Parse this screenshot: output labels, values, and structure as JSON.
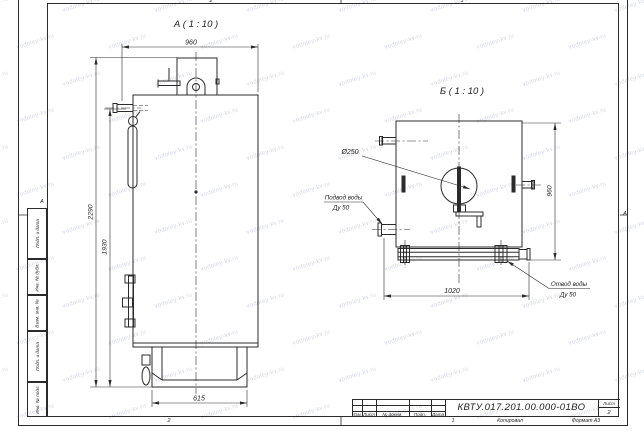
{
  "sheet": {
    "background": "#ffffff",
    "line_color": "#2b2b2b",
    "watermark": "vodoley-kv.ru",
    "zones": {
      "top_left": "2",
      "top_right": "1",
      "bottom_left": "2",
      "bottom_right": "1",
      "side_left": "А",
      "side_right": "А"
    }
  },
  "views": {
    "a": {
      "title": "А ( 1 : 10 )",
      "dim_width": "960",
      "dim_height_total": "2290",
      "dim_height_body": "1930",
      "dim_base": "615"
    },
    "b": {
      "title": "Б ( 1 : 10 )",
      "dim_width": "1020",
      "dim_height": "960",
      "dim_flue": "Ø250",
      "inlet_label": "Подвод воды",
      "inlet_size": "Ду 50",
      "outlet_label": "Отвод воды",
      "outlet_size": "Ду 50"
    }
  },
  "title_block": {
    "doc_number": "КВТУ.017.201.00.000-01ВО",
    "sheet_label": "Лист",
    "sheet_number": "2",
    "headers": [
      "Изм.",
      "Лист",
      "№ докум.",
      "Подп.",
      "Дата"
    ],
    "copied_label": "Копировал",
    "format_label": "Формат А3"
  },
  "side_stamp": [
    "Подп. и дата",
    "Инв. № дубл.",
    "Взам. инв. №",
    "Подп. и дата",
    "Инв. № подл."
  ]
}
